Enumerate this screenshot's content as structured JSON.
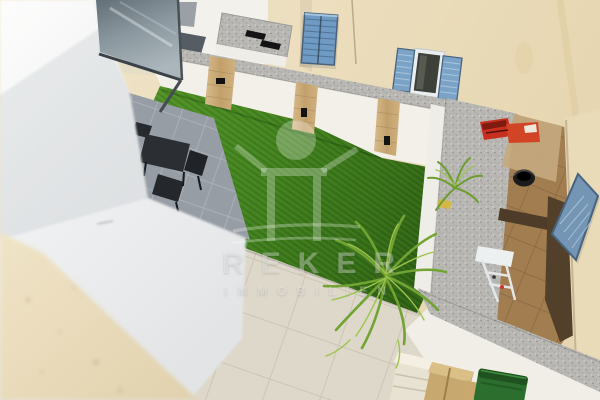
{
  "photo": {
    "kind": "real-estate courtyard photo, elevated view",
    "watermark": {
      "brand": "REKER",
      "subtitle": "IMMOBILIEN",
      "logo_icon": "person-arms-raised-logo"
    },
    "palette": {
      "lawn_green": "#44831f",
      "shutter_blue": "#7da6c9",
      "cream_wall": "#ecdfc0",
      "coping_grey": "#b9b8b4",
      "terrace_brown": "#a17d50",
      "patio_beige": "#d9d3c6",
      "patio_grey": "#a2a8ae",
      "bin_green": "#2c6e2d",
      "red_boxes": "#c82f1e",
      "wood_panel": "#cdb184"
    }
  }
}
